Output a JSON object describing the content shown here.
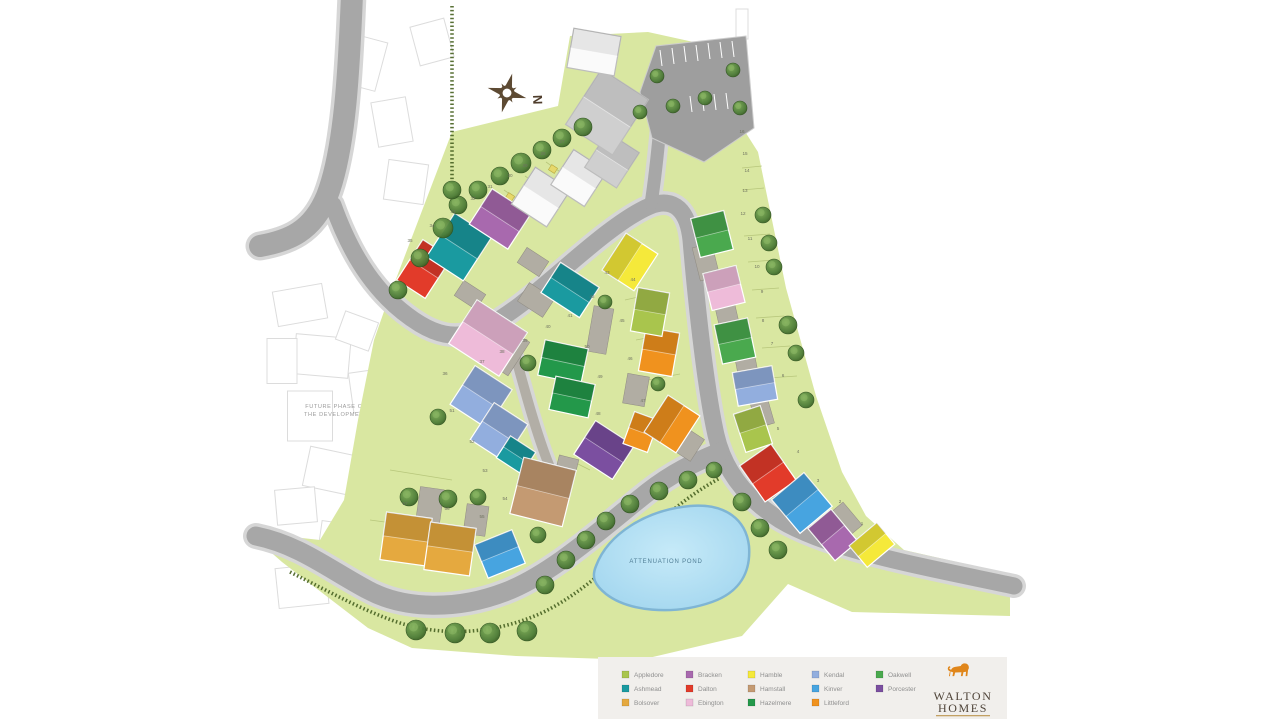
{
  "site": {
    "future_label_line1": "FUTURE PHASE OF",
    "future_label_line2": "THE DEVELOPMENT",
    "pond_label": "ATTENUATION POND",
    "compass_label": "N"
  },
  "legend": {
    "background": "#f1efec",
    "text_color": "#8f8f8f",
    "columns": [
      {
        "items": [
          {
            "label": "Appledore",
            "color": "#a9c54d"
          },
          {
            "label": "Ashmead",
            "color": "#1a9aa0"
          },
          {
            "label": "Bolsover",
            "color": "#e5a93f"
          }
        ]
      },
      {
        "items": [
          {
            "label": "Bracken",
            "color": "#a869ae"
          },
          {
            "label": "Dalton",
            "color": "#e23b2a"
          },
          {
            "label": "Ebington",
            "color": "#eebbd9"
          }
        ]
      },
      {
        "items": [
          {
            "label": "Hamble",
            "color": "#f5e93a"
          },
          {
            "label": "Hamstall",
            "color": "#c49a72"
          },
          {
            "label": "Hazelmere",
            "color": "#23984a"
          }
        ]
      },
      {
        "items": [
          {
            "label": "Kendal",
            "color": "#92aede"
          },
          {
            "label": "Kinver",
            "color": "#47a4e0"
          },
          {
            "label": "Littleford",
            "color": "#f0921e"
          }
        ]
      },
      {
        "items": [
          {
            "label": "Oakwell",
            "color": "#4aa94e"
          },
          {
            "label": "Porcester",
            "color": "#7b4fa0"
          }
        ]
      }
    ]
  },
  "logo": {
    "name_line1": "WALTON",
    "name_line2": "HOMES",
    "lion_color": "#e0861b",
    "text_color": "#4e4338",
    "rule_color": "#c3a164"
  },
  "map": {
    "site_green": "#d9e7a1",
    "road_color": "#a7a7a7",
    "road_casing": "#d6d6d6",
    "hedge_color": "#4a6424",
    "pond_stroke": "#7fb5d4",
    "colors": {
      "appledore": "#a9c54d",
      "ashmead": "#1a9aa0",
      "bolsover": "#e5a93f",
      "bracken": "#a869ae",
      "dalton": "#e23b2a",
      "ebington": "#eebbd9",
      "hamble": "#f5e93a",
      "hamstall": "#c49a72",
      "hazelmere": "#23984a",
      "kendal": "#92aede",
      "kinver": "#47a4e0",
      "littleford": "#f0921e",
      "oakwell": "#4aa94e",
      "porcester": "#7b4fa0",
      "plain": "#fafafa",
      "roofgray": "#cfcfcf"
    },
    "site_polygon": "388,300 452,132 558,106 570,36 648,32 748,54 744,130 758,152 786,288 816,396 842,472 866,516 904,550 1010,574 1010,616 852,612 788,584 742,636 640,660 516,656 412,648 368,628 282,562 266,548 266,534 320,540 344,500 358,420 374,340",
    "parking_polygon": "640,92 656,46 746,36 754,128 704,162 652,138",
    "roads": [
      {
        "d": "M352,-6 C349,70 345,150 327,196 C312,232 288,241 260,246",
        "w": 22
      },
      {
        "d": "M333,205 C352,258 378,298 420,324 C455,345 480,335 520,305 C558,276 612,222 650,206 C675,196 688,212 691,240 C697,310 706,390 716,435 C724,470 745,498 780,520 C830,550 920,566 1014,586",
        "w": 17
      },
      {
        "d": "M256,536 C300,545 330,570 368,590 C405,610 458,610 505,592 C552,574 600,530 648,492 C672,473 695,462 720,452",
        "w": 19
      },
      {
        "d": "M651,204 C656,172 659,140 662,104",
        "w": 13
      },
      {
        "d": "M511,340 C522,380 535,430 549,465 C554,478 558,492 559,505",
        "w": 10,
        "c": "#b2aea6"
      }
    ],
    "hedges": [
      "M452,6 L452,186",
      "M290,572 C330,592 362,610 397,622 C442,637 492,634 537,615 C582,596 627,550 667,515 C687,498 702,488 720,478"
    ],
    "pond_path": "M596,566 C608,534 646,510 690,506 C726,503 746,520 749,546 C751,572 740,592 712,602 C672,616 628,611 606,594 C595,585 591,578 596,566 Z",
    "pond_label_pos": [
      666,
      563
    ],
    "future_rects": [
      [
        300,
        305,
        50,
        35,
        -10
      ],
      [
        322,
        356,
        55,
        40,
        5
      ],
      [
        310,
        416,
        45,
        50,
        0
      ],
      [
        331,
        471,
        50,
        40,
        12
      ],
      [
        296,
        506,
        40,
        35,
        -5
      ],
      [
        357,
        331,
        35,
        30,
        20
      ],
      [
        366,
        391,
        30,
        40,
        -8
      ],
      [
        282,
        361,
        30,
        45,
        0
      ],
      [
        342,
        541,
        45,
        35,
        8
      ],
      [
        302,
        586,
        50,
        40,
        -6
      ],
      [
        362,
        62,
        40,
        50,
        15
      ],
      [
        392,
        122,
        35,
        45,
        -10
      ],
      [
        406,
        182,
        40,
        40,
        8
      ],
      [
        432,
        42,
        35,
        40,
        -15
      ],
      [
        742,
        24,
        12,
        30,
        0
      ]
    ],
    "future_label_pos": [
      336,
      408
    ],
    "plot_lines": [
      [
        441,
        232,
        474,
        255
      ],
      [
        462,
        218,
        495,
        241
      ],
      [
        483,
        204,
        516,
        227
      ],
      [
        504,
        190,
        537,
        213
      ],
      [
        525,
        176,
        558,
        199
      ],
      [
        546,
        162,
        579,
        185
      ],
      [
        742,
        168,
        762,
        166
      ],
      [
        742,
        190,
        764,
        188
      ],
      [
        744,
        236,
        770,
        234
      ],
      [
        748,
        262,
        774,
        260
      ],
      [
        752,
        290,
        779,
        288
      ],
      [
        756,
        318,
        784,
        316
      ],
      [
        762,
        348,
        790,
        346
      ],
      [
        768,
        378,
        797,
        376
      ],
      [
        390,
        470,
        452,
        480
      ],
      [
        370,
        520,
        430,
        528
      ],
      [
        560,
        455,
        590,
        470
      ],
      [
        625,
        300,
        660,
        292
      ],
      [
        636,
        340,
        668,
        334
      ],
      [
        648,
        380,
        680,
        374
      ]
    ],
    "paving": [
      [
        470,
        295,
        26,
        18,
        33
      ],
      [
        533,
        262,
        26,
        18,
        33
      ],
      [
        508,
        352,
        26,
        40,
        33
      ],
      [
        536,
        300,
        30,
        22,
        33
      ],
      [
        600,
        330,
        20,
        46,
        10
      ],
      [
        636,
        390,
        22,
        30,
        10
      ],
      [
        706,
        262,
        20,
        34,
        -14
      ],
      [
        727,
        315,
        20,
        32,
        -13
      ],
      [
        746,
        363,
        20,
        30,
        -11
      ],
      [
        762,
        412,
        18,
        28,
        -16
      ],
      [
        782,
        490,
        24,
        46,
        -38
      ],
      [
        845,
        520,
        20,
        30,
        -40
      ],
      [
        430,
        505,
        24,
        34,
        8
      ],
      [
        476,
        520,
        22,
        30,
        8
      ],
      [
        566,
        470,
        20,
        26,
        14
      ],
      [
        689,
        445,
        26,
        20,
        -57
      ]
    ],
    "parking_bays": [
      [
        660,
        50,
        662,
        66
      ],
      [
        672,
        48,
        674,
        64
      ],
      [
        684,
        46,
        686,
        62
      ],
      [
        696,
        45,
        698,
        61
      ],
      [
        708,
        43,
        710,
        59
      ],
      [
        720,
        42,
        722,
        58
      ],
      [
        732,
        41,
        734,
        57
      ],
      [
        690,
        96,
        692,
        112
      ],
      [
        702,
        95,
        704,
        111
      ],
      [
        714,
        94,
        716,
        110
      ],
      [
        726,
        93,
        728,
        109
      ]
    ],
    "sheds": [
      [
        466,
        228
      ],
      [
        488,
        212
      ],
      [
        510,
        197
      ],
      [
        531,
        183
      ],
      [
        553,
        169
      ],
      [
        575,
        155
      ]
    ],
    "houses": [
      [
        424,
        269,
        34,
        48,
        33,
        "dalton"
      ],
      [
        459,
        247,
        44,
        52,
        33,
        "ashmead"
      ],
      [
        500,
        219,
        46,
        42,
        33,
        "bracken"
      ],
      [
        541,
        197,
        42,
        44,
        33,
        "plain"
      ],
      [
        579,
        178,
        40,
        42,
        33,
        "plain"
      ],
      [
        612,
        160,
        38,
        42,
        33,
        "roofgray"
      ],
      [
        607,
        112,
        56,
        66,
        33,
        "roofgray"
      ],
      [
        594,
        52,
        48,
        40,
        10,
        "plain"
      ],
      [
        488,
        338,
        60,
        52,
        33,
        "ebington"
      ],
      [
        570,
        290,
        46,
        36,
        33,
        "ashmead"
      ],
      [
        630,
        262,
        44,
        38,
        -57,
        "hamble"
      ],
      [
        563,
        362,
        44,
        36,
        12,
        "hazelmere"
      ],
      [
        572,
        397,
        40,
        34,
        12,
        "hazelmere"
      ],
      [
        481,
        397,
        44,
        46,
        33,
        "kendal"
      ],
      [
        499,
        432,
        40,
        44,
        33,
        "kendal"
      ],
      [
        516,
        455,
        30,
        26,
        33,
        "ashmead"
      ],
      [
        604,
        450,
        46,
        40,
        33,
        "porcester"
      ],
      [
        641,
        432,
        26,
        34,
        20,
        "littleford"
      ],
      [
        672,
        424,
        44,
        38,
        -57,
        "littleford"
      ],
      [
        659,
        352,
        34,
        44,
        10,
        "littleford"
      ],
      [
        650,
        312,
        32,
        44,
        10,
        "appledore"
      ],
      [
        712,
        234,
        34,
        40,
        -14,
        "oakwell"
      ],
      [
        724,
        288,
        34,
        38,
        -14,
        "ebington"
      ],
      [
        735,
        341,
        34,
        40,
        -12,
        "oakwell"
      ],
      [
        755,
        386,
        40,
        34,
        -10,
        "kendal"
      ],
      [
        753,
        429,
        28,
        40,
        -18,
        "appledore"
      ],
      [
        768,
        473,
        38,
        44,
        -35,
        "dalton"
      ],
      [
        802,
        503,
        42,
        44,
        -40,
        "kinver"
      ],
      [
        833,
        535,
        30,
        42,
        -40,
        "bracken"
      ],
      [
        872,
        545,
        36,
        28,
        -40,
        "hamble"
      ],
      [
        406,
        539,
        46,
        48,
        8,
        "bolsover"
      ],
      [
        450,
        549,
        46,
        48,
        8,
        "bolsover"
      ],
      [
        500,
        554,
        40,
        36,
        -22,
        "kinver"
      ],
      [
        543,
        492,
        54,
        58,
        14,
        "hamstall"
      ]
    ],
    "trees": [
      [
        398,
        290,
        9
      ],
      [
        420,
        258,
        9
      ],
      [
        443,
        228,
        10
      ],
      [
        458,
        205,
        9
      ],
      [
        478,
        190,
        9
      ],
      [
        500,
        176,
        9
      ],
      [
        521,
        163,
        10
      ],
      [
        542,
        150,
        9
      ],
      [
        562,
        138,
        9
      ],
      [
        583,
        127,
        9
      ],
      [
        640,
        112,
        7
      ],
      [
        673,
        106,
        7
      ],
      [
        705,
        98,
        7
      ],
      [
        740,
        108,
        7
      ],
      [
        657,
        76,
        7
      ],
      [
        733,
        70,
        7
      ],
      [
        763,
        215,
        8
      ],
      [
        769,
        243,
        8
      ],
      [
        774,
        267,
        8
      ],
      [
        788,
        325,
        9
      ],
      [
        796,
        353,
        8
      ],
      [
        806,
        400,
        8
      ],
      [
        545,
        585,
        9
      ],
      [
        566,
        560,
        9
      ],
      [
        586,
        540,
        9
      ],
      [
        606,
        521,
        9
      ],
      [
        630,
        504,
        9
      ],
      [
        659,
        491,
        9
      ],
      [
        688,
        480,
        9
      ],
      [
        714,
        470,
        8
      ],
      [
        742,
        502,
        9
      ],
      [
        760,
        528,
        9
      ],
      [
        778,
        550,
        9
      ],
      [
        416,
        630,
        10
      ],
      [
        455,
        633,
        10
      ],
      [
        490,
        633,
        10
      ],
      [
        527,
        631,
        10
      ],
      [
        409,
        497,
        9
      ],
      [
        448,
        499,
        9
      ],
      [
        478,
        497,
        8
      ],
      [
        538,
        535,
        8
      ],
      [
        438,
        417,
        8
      ],
      [
        528,
        363,
        8
      ],
      [
        605,
        302,
        7
      ],
      [
        658,
        384,
        7
      ],
      [
        452,
        190,
        9
      ]
    ],
    "plot_numbers": [
      [
        "35",
        410,
        242
      ],
      [
        "34",
        432,
        227
      ],
      [
        "33",
        453,
        213
      ],
      [
        "32",
        473,
        200
      ],
      [
        "31",
        490,
        188
      ],
      [
        "30",
        510,
        177
      ],
      [
        "29",
        525,
        167
      ],
      [
        "28",
        543,
        155
      ],
      [
        "27",
        562,
        143
      ],
      [
        "16",
        742,
        133
      ],
      [
        "15",
        745,
        155
      ],
      [
        "14",
        747,
        172
      ],
      [
        "13",
        745,
        192
      ],
      [
        "12",
        743,
        215
      ],
      [
        "11",
        750,
        240
      ],
      [
        "10",
        757,
        268
      ],
      [
        "9",
        762,
        293
      ],
      [
        "8",
        763,
        322
      ],
      [
        "7",
        772,
        345
      ],
      [
        "6",
        783,
        377
      ],
      [
        "5",
        778,
        430
      ],
      [
        "4",
        798,
        453
      ],
      [
        "3",
        818,
        482
      ],
      [
        "2",
        840,
        503
      ],
      [
        "1",
        862,
        525
      ],
      [
        "36",
        445,
        375
      ],
      [
        "37",
        482,
        363
      ],
      [
        "38",
        502,
        353
      ],
      [
        "39",
        525,
        342
      ],
      [
        "40",
        548,
        328
      ],
      [
        "41",
        570,
        317
      ],
      [
        "42",
        592,
        298
      ],
      [
        "43",
        607,
        274
      ],
      [
        "44",
        633,
        281
      ],
      [
        "45",
        622,
        322
      ],
      [
        "46",
        630,
        360
      ],
      [
        "47",
        643,
        402
      ],
      [
        "48",
        598,
        415
      ],
      [
        "49",
        600,
        378
      ],
      [
        "50",
        587,
        348
      ],
      [
        "51",
        452,
        412
      ],
      [
        "52",
        472,
        443
      ],
      [
        "53",
        485,
        472
      ],
      [
        "54",
        505,
        500
      ],
      [
        "55",
        482,
        518
      ],
      [
        "56",
        447,
        510
      ],
      [
        "57",
        405,
        505
      ]
    ],
    "compass": {
      "x": 507,
      "y": 93,
      "color": "#5d4a33"
    }
  }
}
